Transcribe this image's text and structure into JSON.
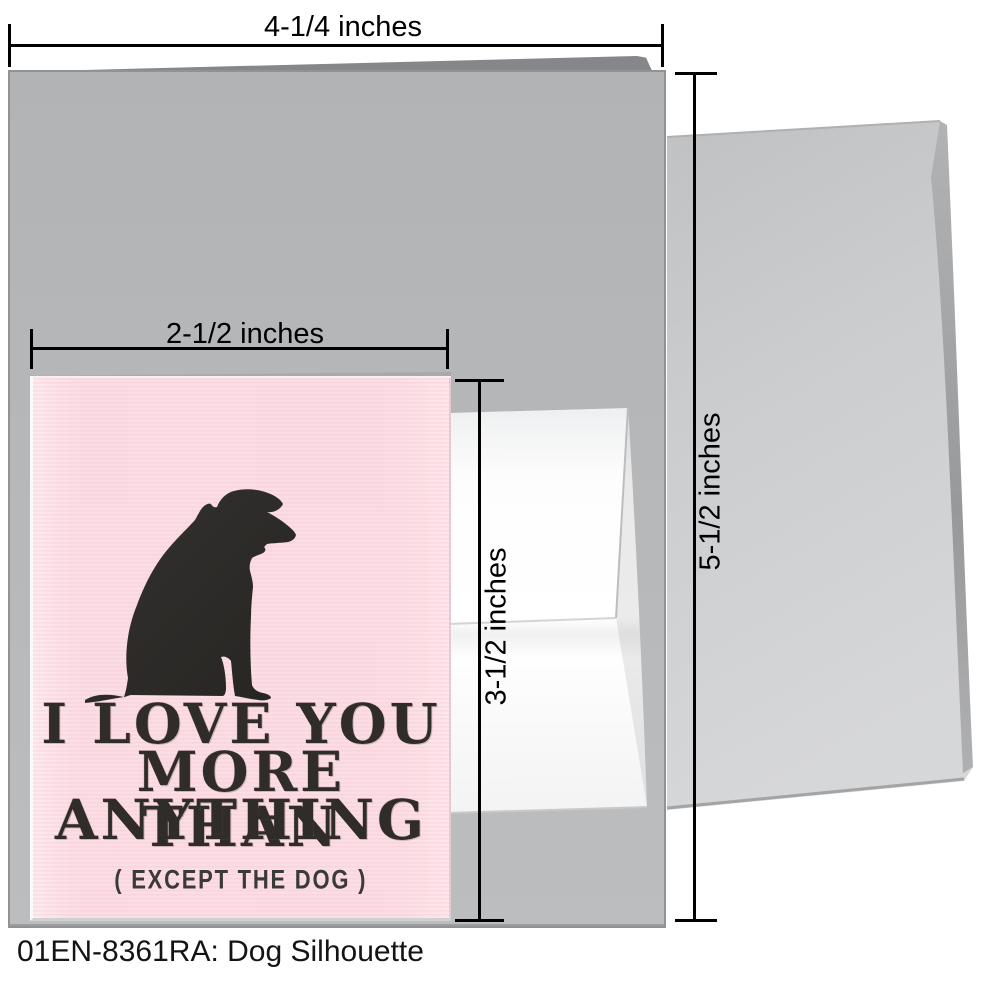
{
  "page": {
    "caption": "01EN-8361RA: Dog Silhouette"
  },
  "measurements": {
    "large_card_width": "4-1/4 inches",
    "envelope_height": "5-1/2 inches",
    "small_card_width": "2-1/2 inches",
    "small_card_height": "3-1/2 inches"
  },
  "greeting_card": {
    "headline_line1": "I LOVE YOU",
    "headline_line2": "MORE THAN",
    "headline_line3": "ANYTHING",
    "subline": "( EXCEPT THE DOG )"
  },
  "icons": {
    "dog": "sitting-dog-silhouette-icon"
  },
  "colors": {
    "card_pink": "#fbdfe5",
    "ink_charcoal": "#2d2b28",
    "large_card_gray": "#b5b7b9",
    "envelope_gray": "#cbcdcf",
    "dimension_black": "#000000"
  }
}
